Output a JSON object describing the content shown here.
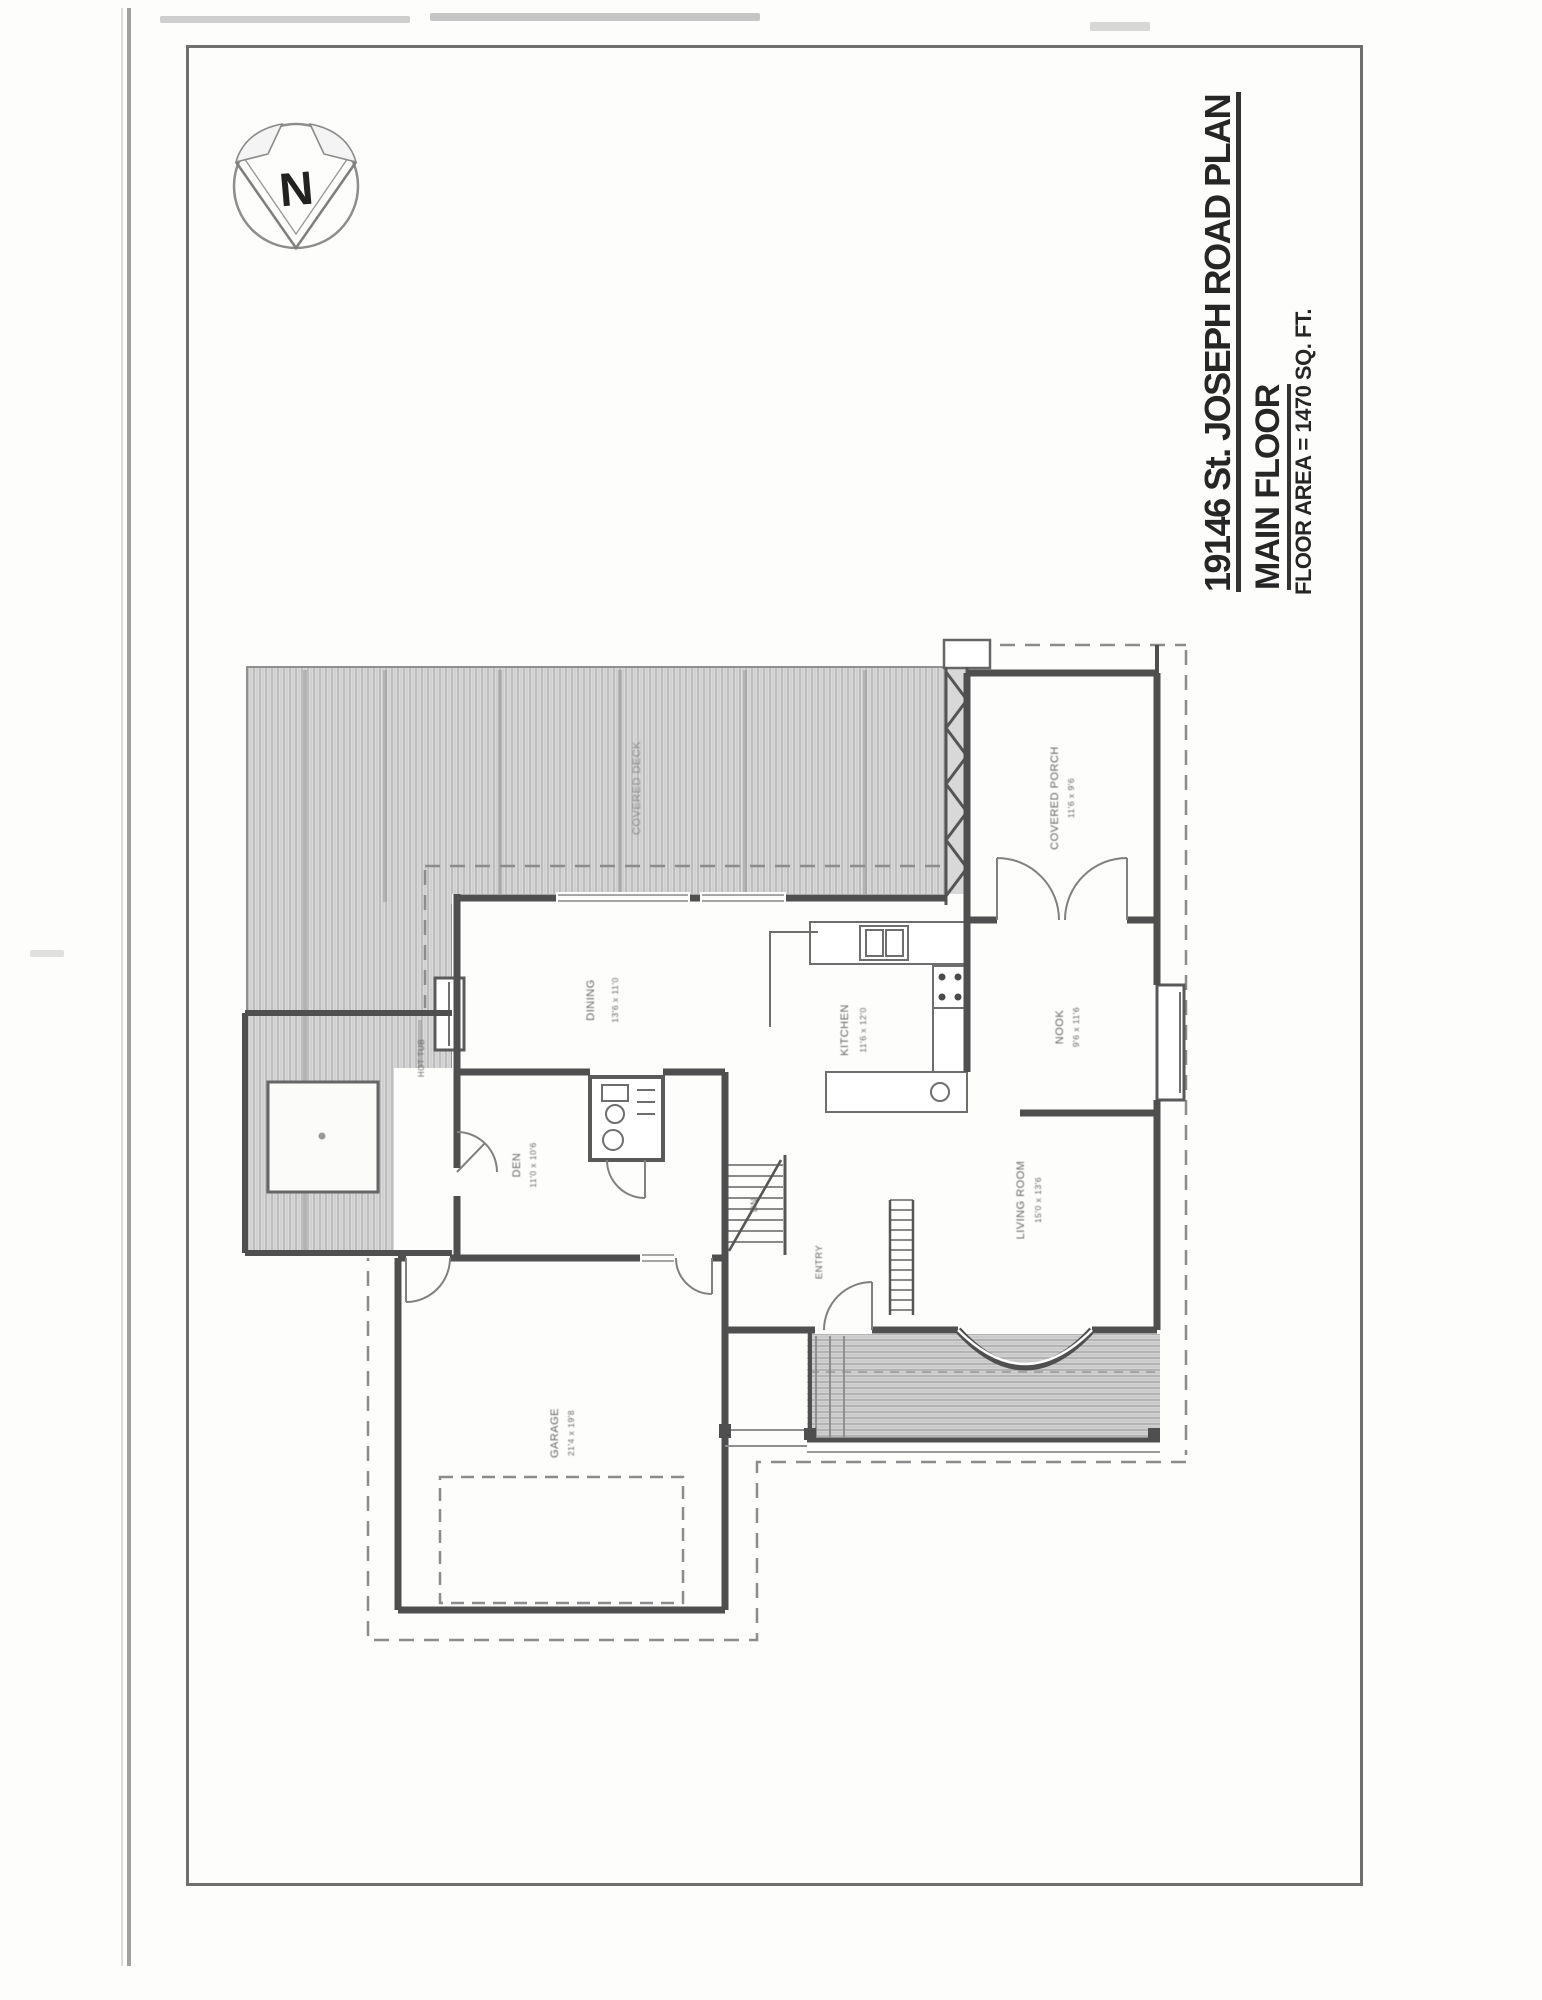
{
  "document": {
    "title": "19146 St. JOSEPH ROAD PLAN",
    "subtitle": "MAIN FLOOR",
    "area_note": "FLOOR AREA = 1470 SQ. FT.",
    "compass": "N"
  },
  "plan": {
    "labels": {
      "covered_deck": "COVERED DECK",
      "covered_porch": "COVERED PORCH",
      "covered_porch_dims": "11'6 x 9'6",
      "dining": "DINING",
      "dining_dims": "13'6 x 11'0",
      "kitchen": "KITCHEN",
      "kitchen_dims": "11'6 x 12'0",
      "nook": "NOOK",
      "nook_dims": "9'6 x 11'6",
      "living": "LIVING ROOM",
      "living_dims": "15'0 x 13'6",
      "den": "DEN",
      "den_dims": "11'0 x 10'6",
      "entry": "ENTRY",
      "garage": "GARAGE",
      "garage_dims": "21'4 x 19'8",
      "hot_tub": "HOT TUB",
      "stair": "DN"
    },
    "colors": {
      "wall": "#4f4f4f",
      "thin_line": "#757575",
      "dashed_line": "#8c8c8c",
      "label_text": "#636363",
      "hatch_line": "#a9a9a9",
      "hatch_bg": "#d9d9d9"
    }
  }
}
